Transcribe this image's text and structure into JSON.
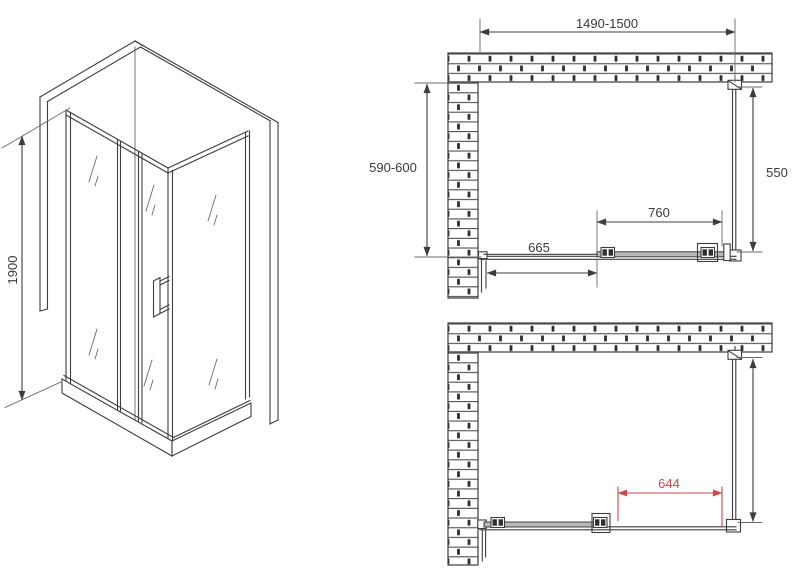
{
  "drawing": {
    "labels": {
      "height": "1900",
      "width_range": "1490-1500",
      "depth_range": "590-600",
      "side_panel": "550",
      "door": "760",
      "fixed_panel": "665",
      "opening": "644"
    },
    "colors": {
      "line": "#3d3d3d",
      "accent_red": "#c84b4b",
      "glass_gray": "#b9b9b9"
    }
  }
}
